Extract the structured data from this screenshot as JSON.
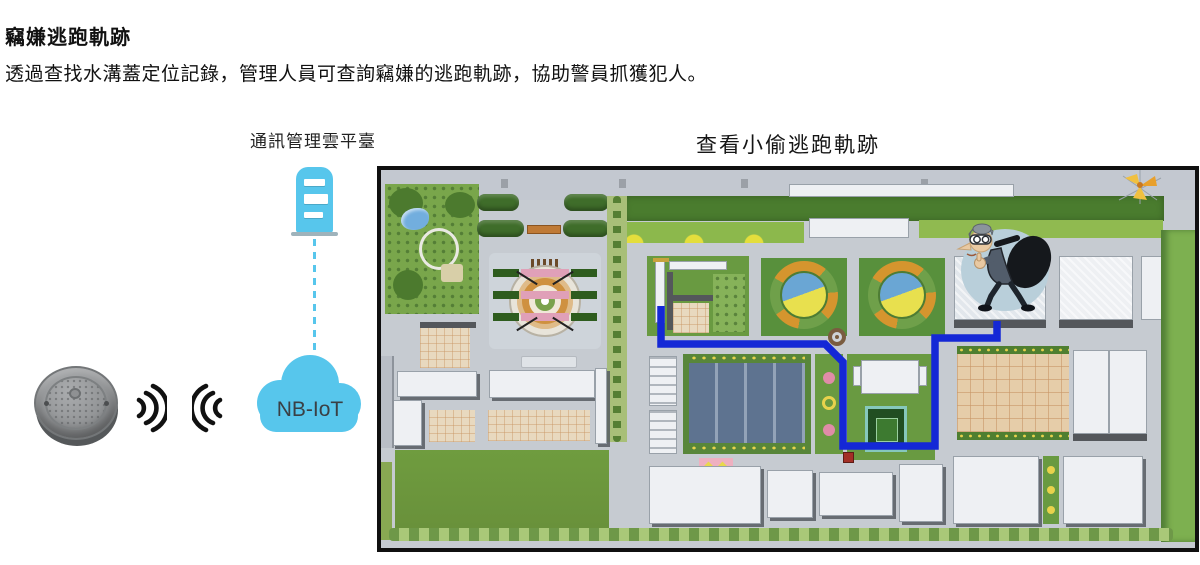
{
  "header": {
    "title": "竊嫌逃跑軌跡",
    "subtitle": "透過查找水溝蓋定位記錄，管理人員可查詢竊嫌的逃跑軌跡，協助警員抓獲犯人。"
  },
  "diagram": {
    "platform_label": "通訊管理雲平臺",
    "cloud_label": "NB-IoT",
    "icons": {
      "manhole": "manhole-cover-icon",
      "signal_out": "radio-waves-right-icon",
      "signal_in": "radio-waves-left-icon",
      "server": "cloud-server-icon",
      "cloud": "nbiot-cloud-icon",
      "link": "dashed-uplink-line"
    }
  },
  "map": {
    "title": "查看小偷逃跑軌跡",
    "icons": {
      "thief": "thief-cartoon-icon",
      "windmill": "windmill-icon",
      "trajectory": "escape-trajectory-path"
    }
  },
  "colors": {
    "accent_blue": "#57c6ec",
    "trajectory_blue": "#1428d6",
    "signal_black": "#111111",
    "map_border": "#101010"
  }
}
